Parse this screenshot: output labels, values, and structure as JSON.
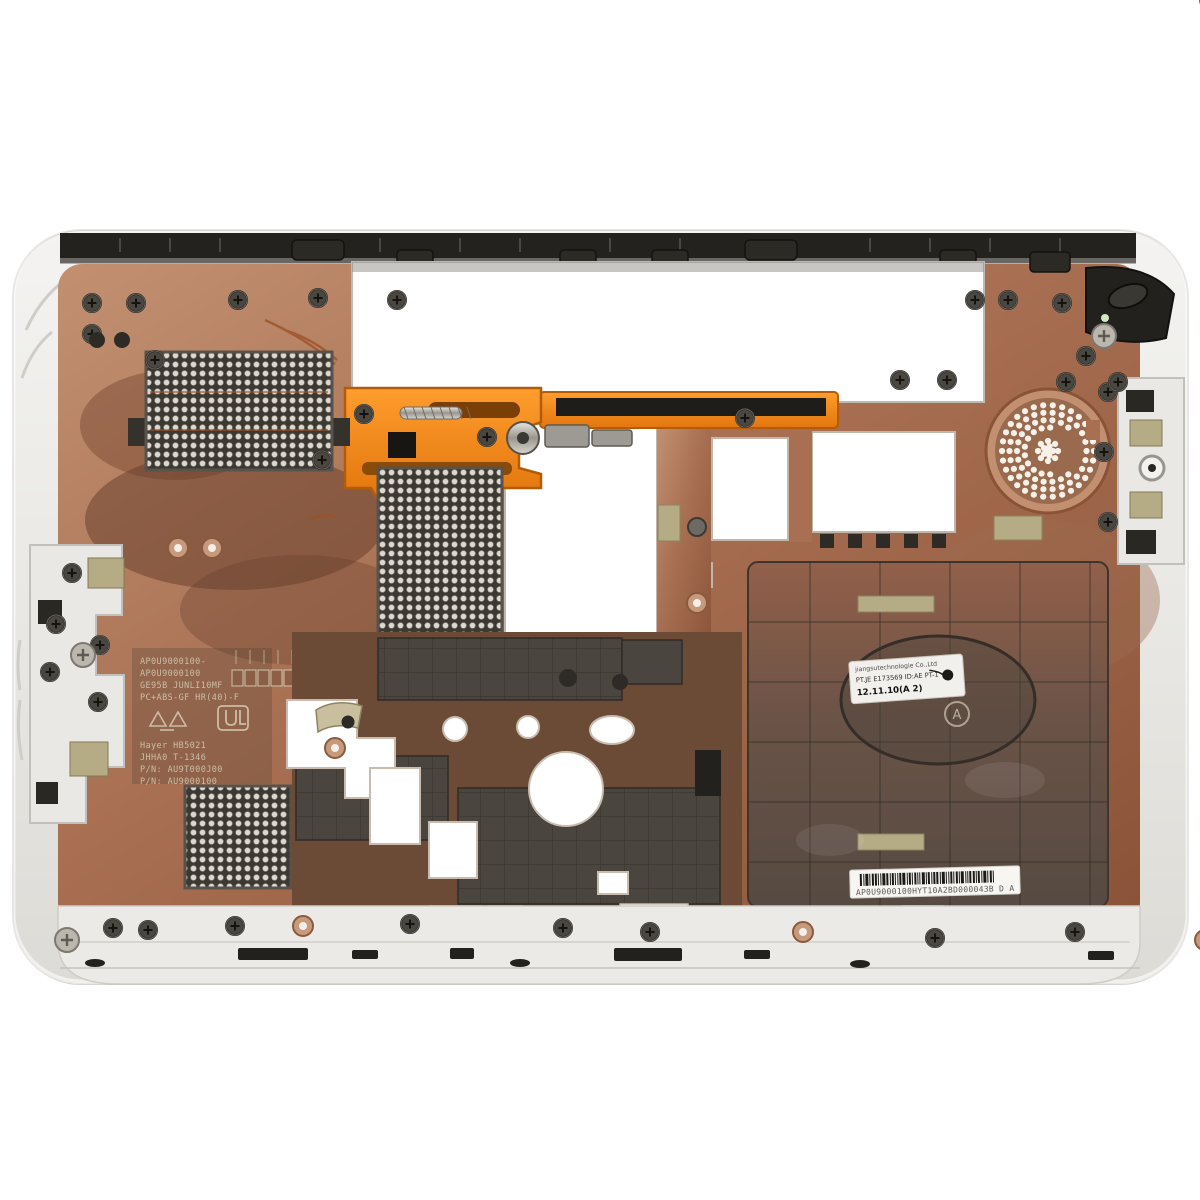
{
  "photo": {
    "subject": "laptop-bottom-case-interior",
    "description": "White laptop bottom base enclosure photographed from the inside, copper EMI coating, orange battery latch, speaker grille and vent meshes",
    "palette": {
      "background": "#ffffff",
      "shell_white": "#ebeae6",
      "copper_light": "#c austria",
      "copper": "#b0795d",
      "copper_dark": "#7e4c36",
      "plastic_dark": "#413c36",
      "black_trim": "#23211d",
      "orange_latch": "#f08418",
      "tape_khaki": "#b5ab84",
      "mesh_dark": "#3c3832"
    },
    "labels": {
      "info_label": {
        "line1": "jiangsutechnologie Co.,Ltd",
        "line2": "PT.JE E173569 ID:AE PT-1",
        "line3": "12.11.10(A 2)"
      },
      "barcode_label": {
        "text": "AP0U9000100HYT10A2BD000043B  D A"
      },
      "molded_text": {
        "line1": "AP0U9000100-",
        "line2": "AP0U9000100",
        "line3": "GE95B JUNLI10MF",
        "line4": "PC+ABS-GF HR(40)-F",
        "line5": "Hayer HB5021",
        "line6": "JHHA0 T-1346",
        "line7": "P/N: AU9T000J00",
        "line8": "P/N: AU9000100"
      },
      "oval_marking": "A"
    }
  }
}
